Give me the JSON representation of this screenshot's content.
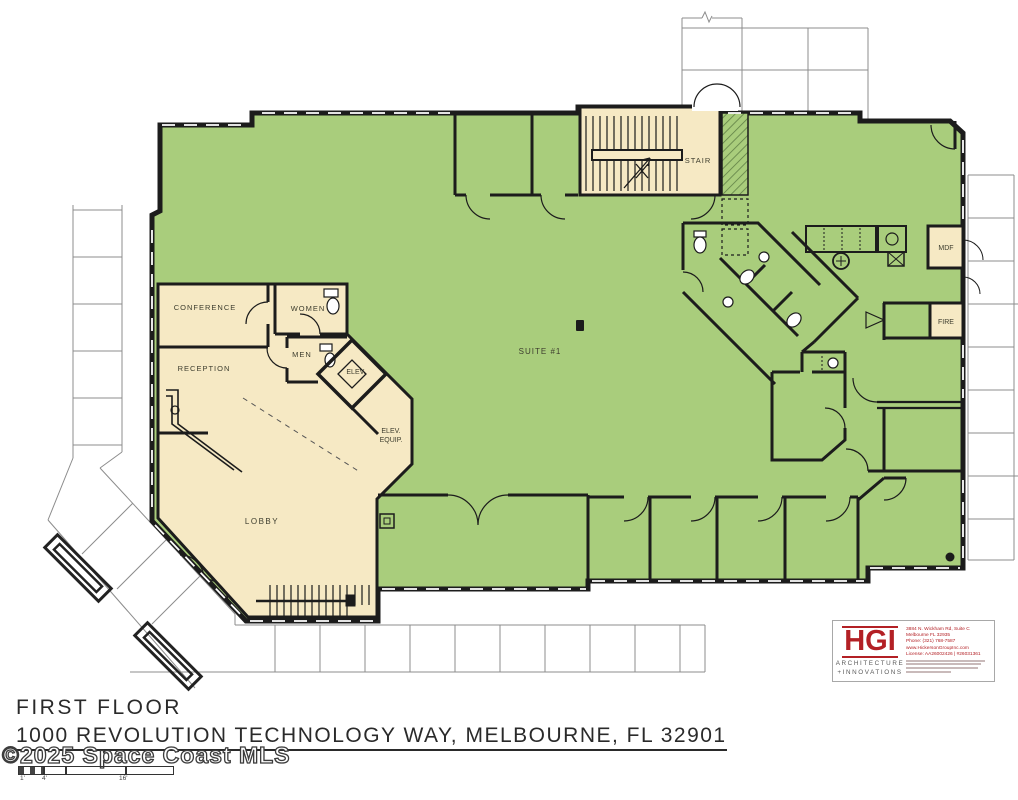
{
  "document": {
    "title_line1": "FIRST FLOOR",
    "title_line2": "1000 REVOLUTION TECHNOLOGY WAY, MELBOURNE, FL 32901"
  },
  "watermark": "©2025 Space Coast MLS",
  "scale_bar": {
    "tick1": "1'",
    "tick2": "4'",
    "tick3": "16'"
  },
  "rooms": {
    "suite": "SUITE #1",
    "lobby": "LOBBY",
    "conference": "CONFERENCE",
    "reception": "RECEPTION",
    "women": "WOMEN",
    "men": "MEN",
    "elevator": "ELEV.",
    "elev_equip_line1": "ELEV.",
    "elev_equip_line2": "EQUIP.",
    "stair": "STAIR",
    "mdf": "MDF",
    "fire": "FIRE"
  },
  "logo": {
    "monogram": "HGI",
    "tagline_line1": "ARCHITECTURE",
    "tagline_line2": "+INNOVATIONS",
    "contact_lines": [
      "3884 N. Wickham Rd, Suite C",
      "Melbourne FL 32935",
      "Phone: (321) 768-7587",
      "www.HickersonGroupInc.com",
      "License: AA26002426 | #26031361"
    ]
  },
  "colors": {
    "suite_green": "#a9cd7c",
    "room_tan": "#f6e9c4",
    "wall_black": "#1c1c1c",
    "site_gray": "#8c8c8c",
    "logo_red": "#b32025"
  }
}
